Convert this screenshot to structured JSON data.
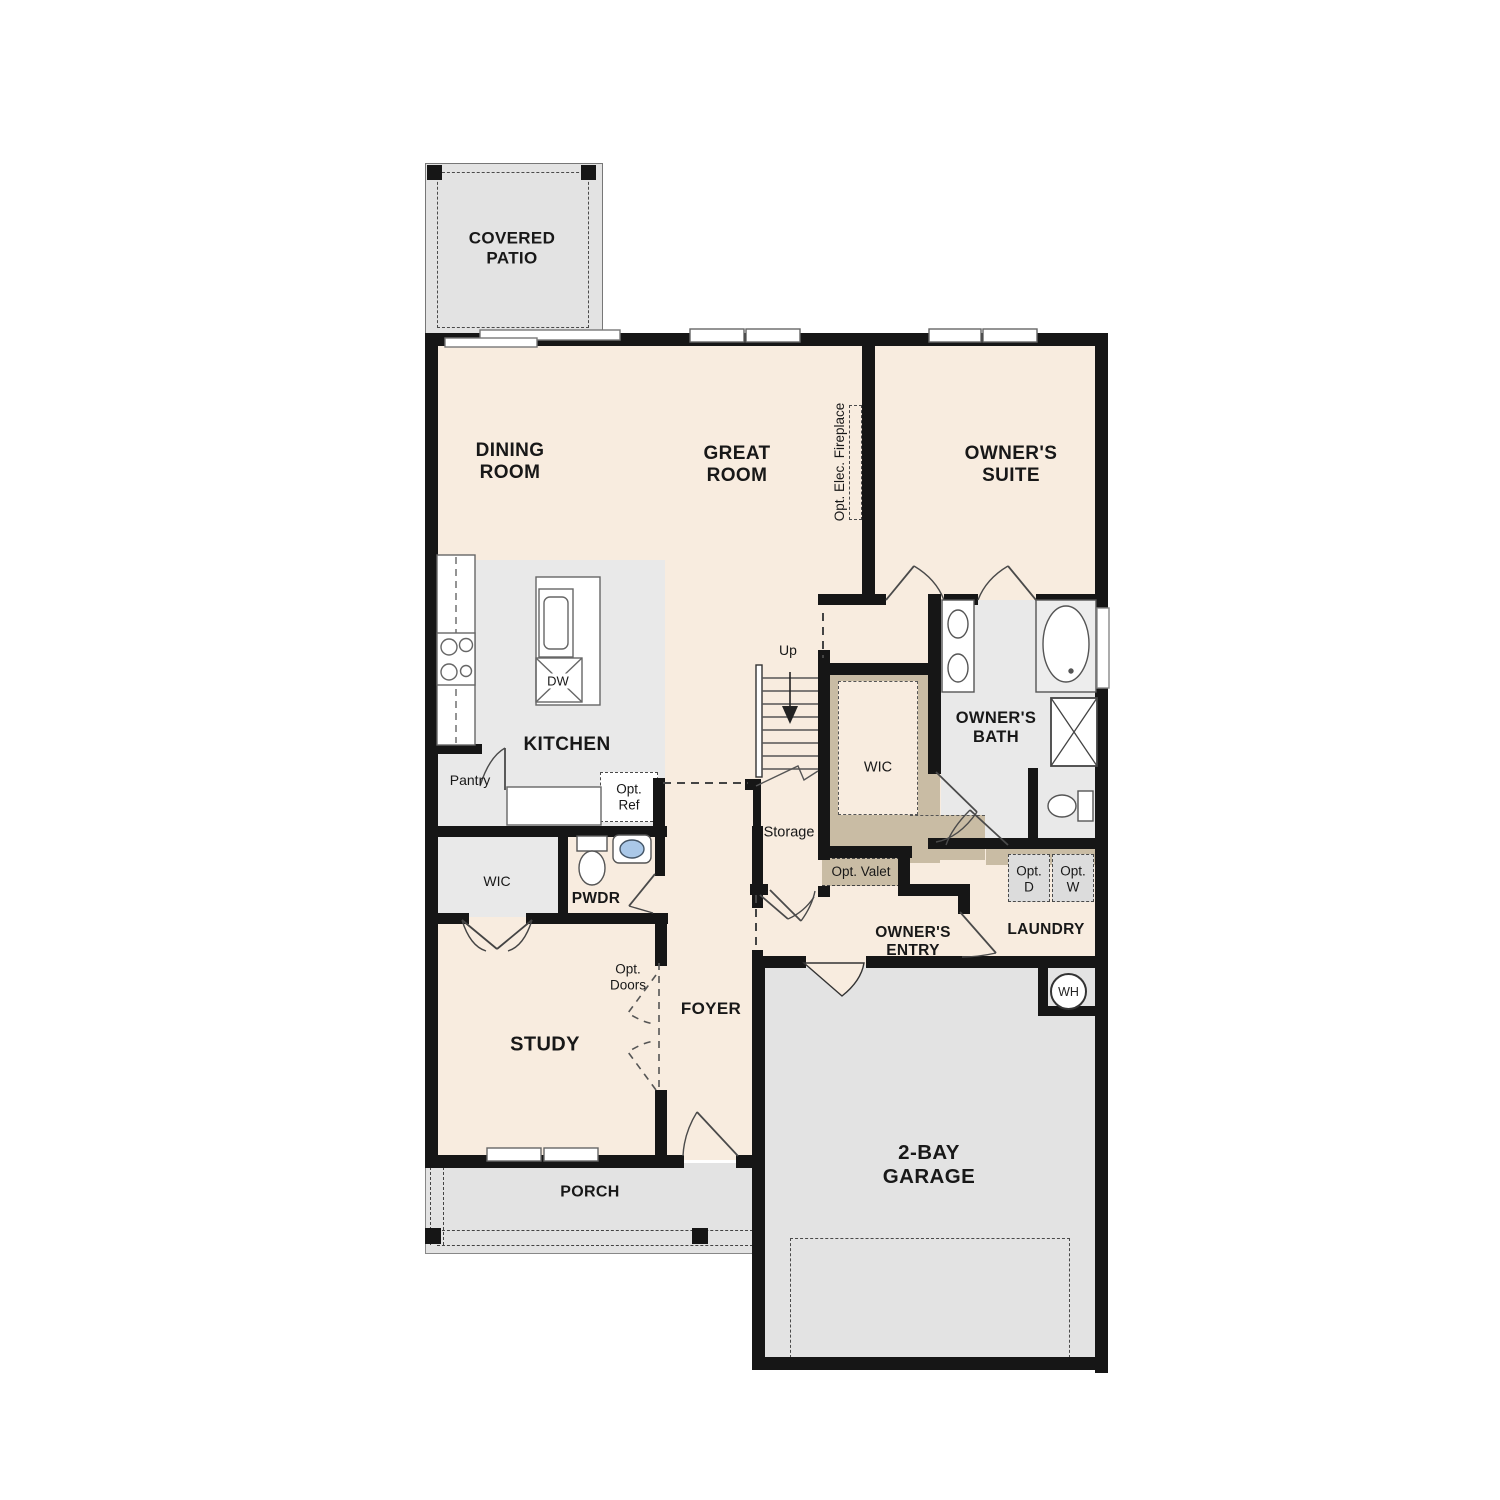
{
  "plan_type": "single-story-floor-plan",
  "colors": {
    "floor_cream": "#f8ecdf",
    "floor_gray_light": "#e9e9e9",
    "floor_gray_outdoor": "#e3e3e3",
    "closet_tan": "#c9bca4",
    "wall_black": "#161616",
    "fixture_line": "#4a4a4a",
    "sink_blue": "#aac8e8",
    "optional_box_gray": "#dcdcdc"
  },
  "labels": {
    "covered_patio": "COVERED\nPATIO",
    "dining_room": "DINING\nROOM",
    "great_room": "GREAT\nROOM",
    "owners_suite": "OWNER'S\nSUITE",
    "fireplace": "Opt. Elec. Fireplace",
    "kitchen": "KITCHEN",
    "dishwasher": "DW",
    "pantry": "Pantry",
    "opt_ref": "Opt.\nRef",
    "stairs_up": "Up",
    "storage": "Storage",
    "wic_center": "WIC",
    "owners_bath": "OWNER'S\nBATH",
    "opt_valet": "Opt. Valet",
    "opt_dryer": "Opt.\nD",
    "opt_washer": "Opt.\nW",
    "laundry": "LAUNDRY",
    "owners_entry": "OWNER'S\nENTRY",
    "wic_left": "WIC",
    "powder": "PWDR",
    "opt_doors": "Opt.\nDoors",
    "foyer": "FOYER",
    "study": "STUDY",
    "porch": "PORCH",
    "garage": "2-BAY\nGARAGE",
    "water_heater": "WH"
  }
}
